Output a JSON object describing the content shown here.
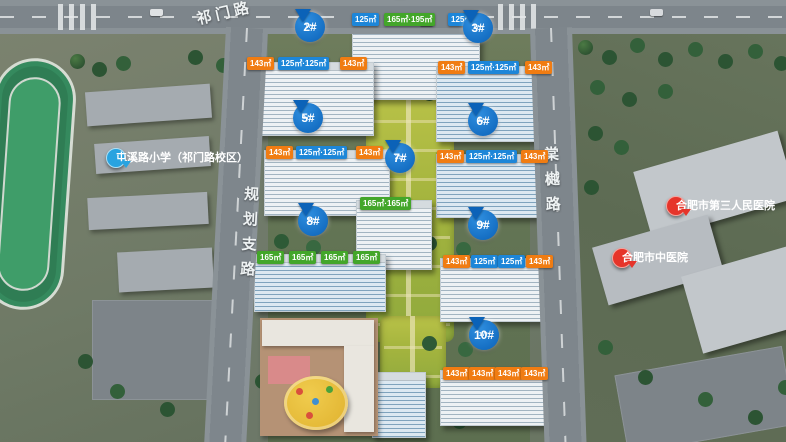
{
  "roads": {
    "top": "祁门路",
    "left": "规划支路",
    "right": "棠樾路"
  },
  "poi": {
    "school": "屯溪路小学（祁门路校区）",
    "hospital_1": "合肥市第三人民医院",
    "hospital_2": "合肥市中医院"
  },
  "palette": {
    "unit_blue": "#1d86d8",
    "unit_orange": "#f07c12",
    "unit_green": "#43a62a",
    "pin_blue": "#0b62b8",
    "poi_red": "#e6342a",
    "poi_blue": "#28a3e0"
  },
  "buildings": [
    {
      "badge": "1#",
      "floors": "",
      "units": [
        {
          "text": "125㎡",
          "color": "blue"
        },
        {
          "text": "165㎡·195㎡",
          "color": "green"
        },
        {
          "text": "125㎡",
          "color": "blue"
        }
      ]
    },
    {
      "badge": "2#",
      "floors": "17F",
      "units": [
        {
          "text": "143㎡",
          "color": "orange"
        },
        {
          "text": "125㎡·125㎡",
          "color": "blue"
        },
        {
          "text": "143㎡",
          "color": "orange"
        }
      ]
    },
    {
      "badge": "3#",
      "floors": "17F",
      "units": [
        {
          "text": "143㎡",
          "color": "orange"
        },
        {
          "text": "125㎡·125㎡",
          "color": "blue"
        },
        {
          "text": "143㎡",
          "color": "orange"
        }
      ]
    },
    {
      "badge": "5#",
      "floors": "17F",
      "units": [
        {
          "text": "143㎡",
          "color": "orange"
        },
        {
          "text": "125㎡·125㎡",
          "color": "blue"
        },
        {
          "text": "143㎡",
          "color": "orange"
        }
      ]
    },
    {
      "badge": "6#",
      "floors": "17F",
      "units": [
        {
          "text": "143㎡",
          "color": "orange"
        },
        {
          "text": "125㎡·125㎡",
          "color": "blue"
        },
        {
          "text": "143㎡",
          "color": "orange"
        }
      ]
    },
    {
      "badge": "7#",
      "floors": "21F",
      "units": [
        {
          "text": "165㎡·165㎡",
          "color": "green"
        }
      ]
    },
    {
      "badge": "8#",
      "floors": "17F",
      "units": [
        {
          "text": "165㎡",
          "color": "green"
        },
        {
          "text": "165㎡",
          "color": "green"
        },
        {
          "text": "165㎡",
          "color": "green"
        },
        {
          "text": "165㎡",
          "color": "green"
        }
      ]
    },
    {
      "badge": "9#",
      "floors": "17F",
      "units": [
        {
          "text": "143㎡",
          "color": "orange"
        },
        {
          "text": "125㎡",
          "color": "blue"
        },
        {
          "text": "125㎡",
          "color": "blue"
        },
        {
          "text": "143㎡",
          "color": "orange"
        }
      ]
    },
    {
      "badge": "10#",
      "floors": "17F",
      "units": [
        {
          "text": "143㎡",
          "color": "orange"
        },
        {
          "text": "143㎡",
          "color": "orange"
        },
        {
          "text": "143㎡",
          "color": "orange"
        },
        {
          "text": "143㎡",
          "color": "orange"
        }
      ]
    }
  ]
}
